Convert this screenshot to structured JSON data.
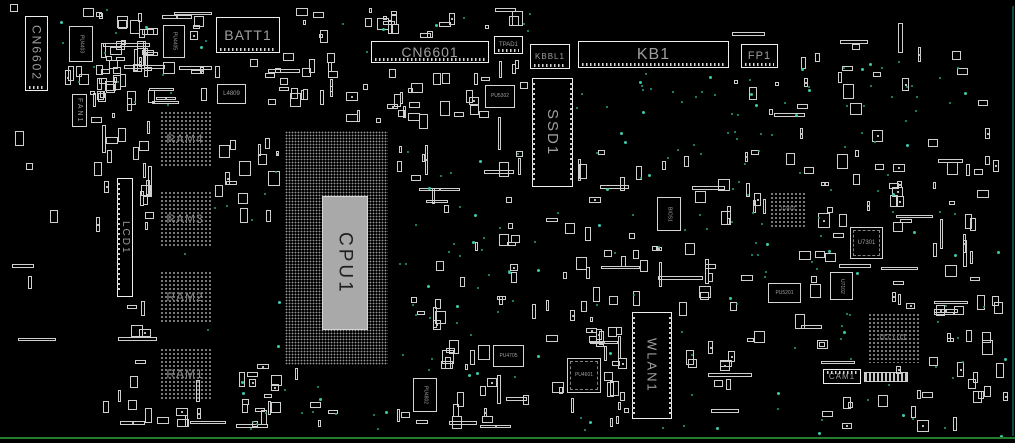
{
  "board": {
    "width": 1015,
    "height": 443,
    "colors": {
      "background": "#000000",
      "outline": "#d6d6d6",
      "outline_bright": "#efefef",
      "label": "#9e9e9e",
      "label_dim": "#818181",
      "die_fill": "#a9a9a9",
      "die_text": "#1f1f1f",
      "dot": "#9a9a9a",
      "testpoint": "#22a18b",
      "testpoint_bright": "#3cc9ab",
      "bottom_line": "#237c2f",
      "edge_line": "#0d4a42"
    }
  },
  "components": [
    {
      "id": "cn6602",
      "label": "CN6602",
      "x": 25,
      "y": 16,
      "w": 23,
      "h": 75,
      "type": "connector",
      "dir": "v",
      "fs": 12,
      "pins": "bottom"
    },
    {
      "id": "fan1",
      "label": "FAN1",
      "x": 72,
      "y": 94,
      "w": 15,
      "h": 33,
      "type": "ic",
      "dir": "v",
      "fs": 7
    },
    {
      "id": "pu4403",
      "label": "PU4403",
      "x": 69,
      "y": 26,
      "w": 24,
      "h": 36,
      "type": "ic",
      "dir": "v",
      "fs": 5
    },
    {
      "id": "pu4405",
      "label": "PU4405",
      "x": 163,
      "y": 25,
      "w": 22,
      "h": 33,
      "type": "ic",
      "dir": "v",
      "fs": 5
    },
    {
      "id": "batt1",
      "label": "BATT1",
      "x": 216,
      "y": 17,
      "w": 64,
      "h": 36,
      "type": "connector",
      "dir": "h",
      "fs": 14,
      "pins": "bottom"
    },
    {
      "id": "l4809",
      "label": "L4809",
      "x": 217,
      "y": 84,
      "w": 29,
      "h": 20,
      "type": "ic",
      "dir": "h",
      "fs": 6
    },
    {
      "id": "cn6601",
      "label": "CN6601",
      "x": 371,
      "y": 41,
      "w": 118,
      "h": 22,
      "type": "connector",
      "dir": "h",
      "fs": 14,
      "pins": "bottom"
    },
    {
      "id": "tpad1",
      "label": "TPAD1",
      "x": 494,
      "y": 36,
      "w": 29,
      "h": 18,
      "type": "connector",
      "dir": "h",
      "fs": 6,
      "pins": "bottom"
    },
    {
      "id": "kbbl1",
      "label": "KBBL1",
      "x": 530,
      "y": 44,
      "w": 40,
      "h": 25,
      "type": "connector",
      "dir": "h",
      "fs": 8,
      "pins": "bottom"
    },
    {
      "id": "kb1",
      "label": "KB1",
      "x": 578,
      "y": 41,
      "w": 151,
      "h": 27,
      "type": "connector",
      "dir": "h",
      "fs": 16,
      "pins": "bottom"
    },
    {
      "id": "fp1",
      "label": "FP1",
      "x": 741,
      "y": 44,
      "w": 37,
      "h": 24,
      "type": "connector",
      "dir": "h",
      "fs": 11,
      "pins": "bottom"
    },
    {
      "id": "pu5302",
      "label": "PU5302",
      "x": 485,
      "y": 85,
      "w": 30,
      "h": 23,
      "type": "ic",
      "dir": "h",
      "fs": 5
    },
    {
      "id": "ssd1",
      "label": "SSD1",
      "x": 532,
      "y": 78,
      "w": 41,
      "h": 109,
      "type": "connector",
      "dir": "v",
      "fs": 15,
      "pins": "sides"
    },
    {
      "id": "ram4",
      "label": "RAM4",
      "x": 159,
      "y": 110,
      "w": 52,
      "h": 57,
      "type": "bga",
      "dir": "h",
      "fs": 12
    },
    {
      "id": "ram3",
      "label": "RAM3",
      "x": 159,
      "y": 190,
      "w": 52,
      "h": 57,
      "type": "bga",
      "dir": "h",
      "fs": 12
    },
    {
      "id": "ram2",
      "label": "RAM2",
      "x": 159,
      "y": 270,
      "w": 52,
      "h": 53,
      "type": "bga",
      "dir": "h",
      "fs": 12
    },
    {
      "id": "ram1",
      "label": "RAM1",
      "x": 159,
      "y": 347,
      "w": 52,
      "h": 53,
      "type": "bga",
      "dir": "h",
      "fs": 12
    },
    {
      "id": "lcd1",
      "label": "LCD1",
      "x": 117,
      "y": 178,
      "w": 16,
      "h": 119,
      "type": "connector",
      "dir": "v",
      "fs": 10,
      "pins": "left"
    },
    {
      "id": "cpu1",
      "label": "CPU1",
      "x": 285,
      "y": 131,
      "w": 103,
      "h": 234,
      "type": "cpu",
      "dir": "v",
      "fs": 19,
      "die": {
        "x": 322,
        "y": 196,
        "w": 46,
        "h": 134
      }
    },
    {
      "id": "bios1",
      "label": "BIOS1",
      "x": 657,
      "y": 197,
      "w": 24,
      "h": 34,
      "type": "ic",
      "dir": "v",
      "fs": 5
    },
    {
      "id": "wlan1",
      "label": "WLAN1",
      "x": 632,
      "y": 312,
      "w": 40,
      "h": 107,
      "type": "connector",
      "dir": "v",
      "fs": 13,
      "pins": "sides"
    },
    {
      "id": "pu4705",
      "label": "PU4705",
      "x": 493,
      "y": 345,
      "w": 31,
      "h": 22,
      "type": "ic",
      "dir": "h",
      "fs": 5
    },
    {
      "id": "pu4601",
      "label": "PU4601",
      "x": 567,
      "y": 358,
      "w": 34,
      "h": 35,
      "type": "qfp",
      "dir": "h",
      "fs": 5
    },
    {
      "id": "pu4802",
      "label": "PU4802",
      "x": 413,
      "y": 378,
      "w": 24,
      "h": 34,
      "type": "ic",
      "dir": "v",
      "fs": 5
    },
    {
      "id": "u2402",
      "label": "U2402",
      "x": 769,
      "y": 191,
      "w": 38,
      "h": 36,
      "type": "bga",
      "dir": "h",
      "fs": 5
    },
    {
      "id": "u7301",
      "label": "U7301",
      "x": 850,
      "y": 227,
      "w": 33,
      "h": 32,
      "type": "qfp",
      "dir": "h",
      "fs": 6
    },
    {
      "id": "u7102",
      "label": "U7102",
      "x": 830,
      "y": 272,
      "w": 23,
      "h": 28,
      "type": "ic",
      "dir": "v",
      "fs": 5
    },
    {
      "id": "pu5201",
      "label": "PU5201",
      "x": 768,
      "y": 283,
      "w": 33,
      "h": 20,
      "type": "ic",
      "dir": "h",
      "fs": 5
    },
    {
      "id": "u7101",
      "label": "U7101",
      "x": 867,
      "y": 312,
      "w": 53,
      "h": 51,
      "type": "bga",
      "dir": "h",
      "fs": 8
    },
    {
      "id": "cam1",
      "label": "CAM1",
      "x": 823,
      "y": 369,
      "w": 38,
      "h": 15,
      "type": "connector",
      "dir": "h",
      "fs": 8,
      "pins": "top"
    }
  ]
}
